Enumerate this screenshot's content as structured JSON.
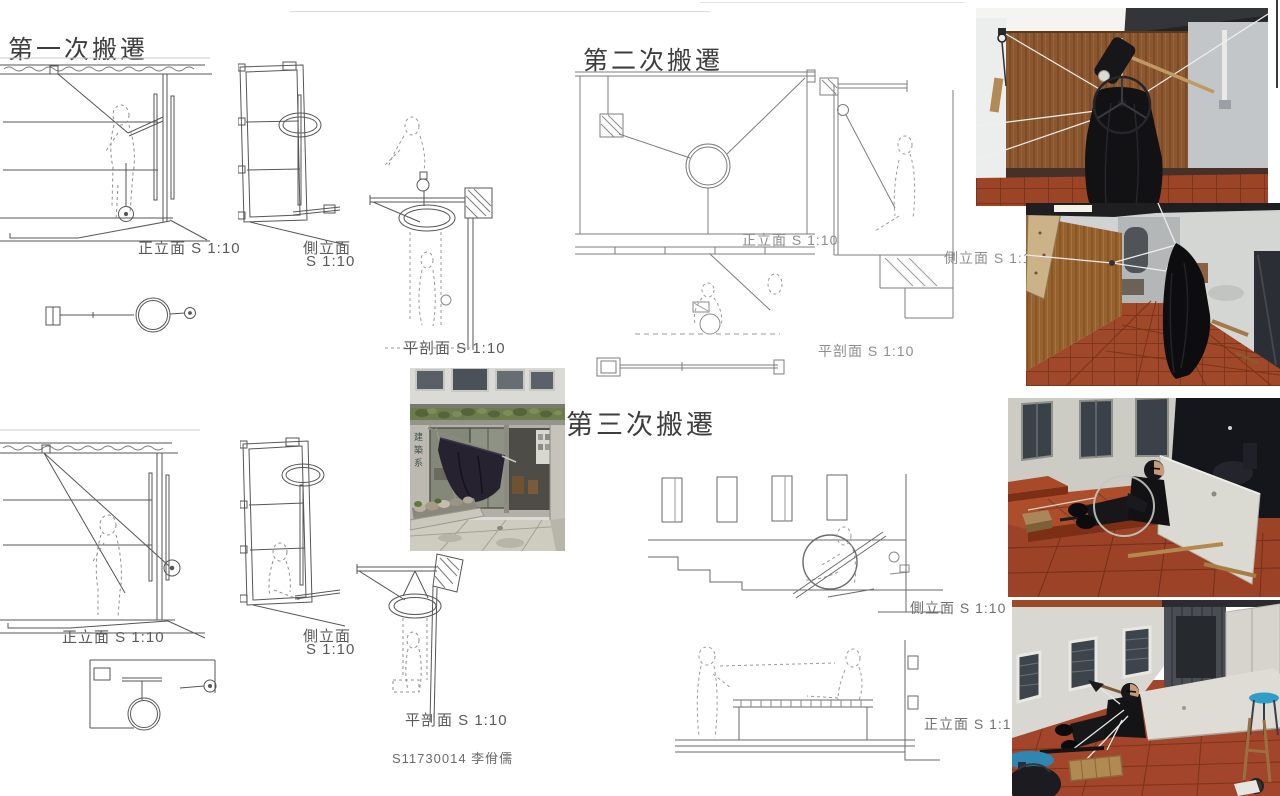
{
  "titles": {
    "first": "第一次搬遷",
    "second": "第二次搬遷",
    "third": "第三次搬遷"
  },
  "labels": {
    "front_elevation": "正立面 S 1:10",
    "side_elevation": "側立面 S 1:10",
    "side_elevation_l1": "側立面",
    "side_elevation_l2": "S 1:10",
    "plan_section": "平剖面 S 1:10"
  },
  "signature": "S11730014 李佾儒",
  "photos": {
    "storefront_sign": "建築系"
  },
  "colors": {
    "drawing_line": "#565656",
    "drawing_line_light": "#8a8a8a",
    "wood_wall": "#8f5a2e",
    "terracotta_tile": "#a0482a",
    "black_fabric": "#121215",
    "night_sky": "#15161b",
    "stool_blue": "#2f86b2"
  }
}
